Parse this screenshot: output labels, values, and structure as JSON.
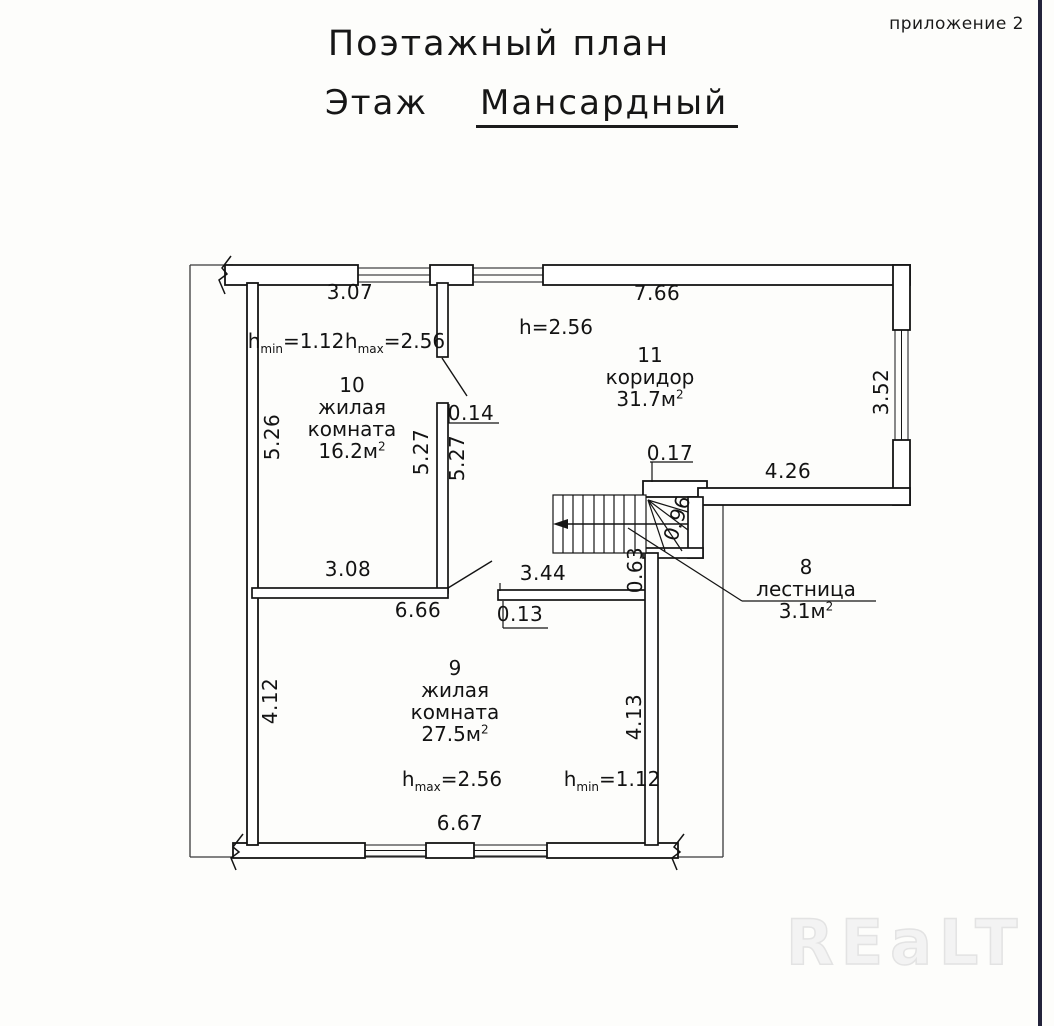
{
  "header": {
    "title": "Поэтажный план",
    "floor_label": "Этаж",
    "floor_value": "Мансардный",
    "annex": "приложение 2"
  },
  "watermark": "REaLT",
  "rooms": [
    {
      "number": "10",
      "name_lines": [
        "жилая",
        "комната"
      ],
      "area": "16.2м",
      "area_sup": "2",
      "x": 352,
      "y": 374
    },
    {
      "number": "11",
      "name_lines": [
        "коридор"
      ],
      "area": "31.7м",
      "area_sup": "2",
      "x": 650,
      "y": 344
    },
    {
      "number": "9",
      "name_lines": [
        "жилая",
        "комната"
      ],
      "area": "27.5м",
      "area_sup": "2",
      "x": 455,
      "y": 657
    },
    {
      "number": "8",
      "name_lines": [
        "лестница"
      ],
      "area": "3.1м",
      "area_sup": "2",
      "x": 806,
      "y": 556
    }
  ],
  "heights": [
    {
      "base": "h",
      "sub": "min",
      "eq": "=1.12",
      "x": 296,
      "y": 341
    },
    {
      "base": "h",
      "sub": "max",
      "eq": "=2.56",
      "x": 395,
      "y": 341
    },
    {
      "base": "h",
      "sub": "",
      "eq": "=2.56",
      "x": 556,
      "y": 327
    },
    {
      "base": "h",
      "sub": "max",
      "eq": "=2.56",
      "x": 452,
      "y": 779
    },
    {
      "base": "h",
      "sub": "min",
      "eq": "=1.12",
      "x": 612,
      "y": 779
    }
  ],
  "dimensions": [
    {
      "text": "3.07",
      "x": 350,
      "y": 292,
      "rot": 0
    },
    {
      "text": "7.66",
      "x": 657,
      "y": 293,
      "rot": 0
    },
    {
      "text": "5.26",
      "x": 272,
      "y": 437,
      "rot": -90
    },
    {
      "text": "0.14",
      "x": 471,
      "y": 413,
      "rot": 0
    },
    {
      "text": "5.27",
      "x": 421,
      "y": 452,
      "rot": -90
    },
    {
      "text": "5.27",
      "x": 457,
      "y": 458,
      "rot": -90
    },
    {
      "text": "3.08",
      "x": 348,
      "y": 569,
      "rot": 0
    },
    {
      "text": "6.66",
      "x": 418,
      "y": 610,
      "rot": 0
    },
    {
      "text": "3.44",
      "x": 543,
      "y": 573,
      "rot": 0
    },
    {
      "text": "0.13",
      "x": 520,
      "y": 614,
      "rot": 0
    },
    {
      "text": "0.17",
      "x": 670,
      "y": 453,
      "rot": 0
    },
    {
      "text": "4.26",
      "x": 788,
      "y": 471,
      "rot": 0
    },
    {
      "text": "3.52",
      "x": 881,
      "y": 392,
      "rot": -90
    },
    {
      "text": "0.96",
      "x": 677,
      "y": 518,
      "rot": -72
    },
    {
      "text": "0.63",
      "x": 635,
      "y": 570,
      "rot": -90
    },
    {
      "text": "4.12",
      "x": 270,
      "y": 701,
      "rot": -90
    },
    {
      "text": "4.13",
      "x": 634,
      "y": 717,
      "rot": -90
    },
    {
      "text": "6.67",
      "x": 460,
      "y": 823,
      "rot": 0
    }
  ]
}
